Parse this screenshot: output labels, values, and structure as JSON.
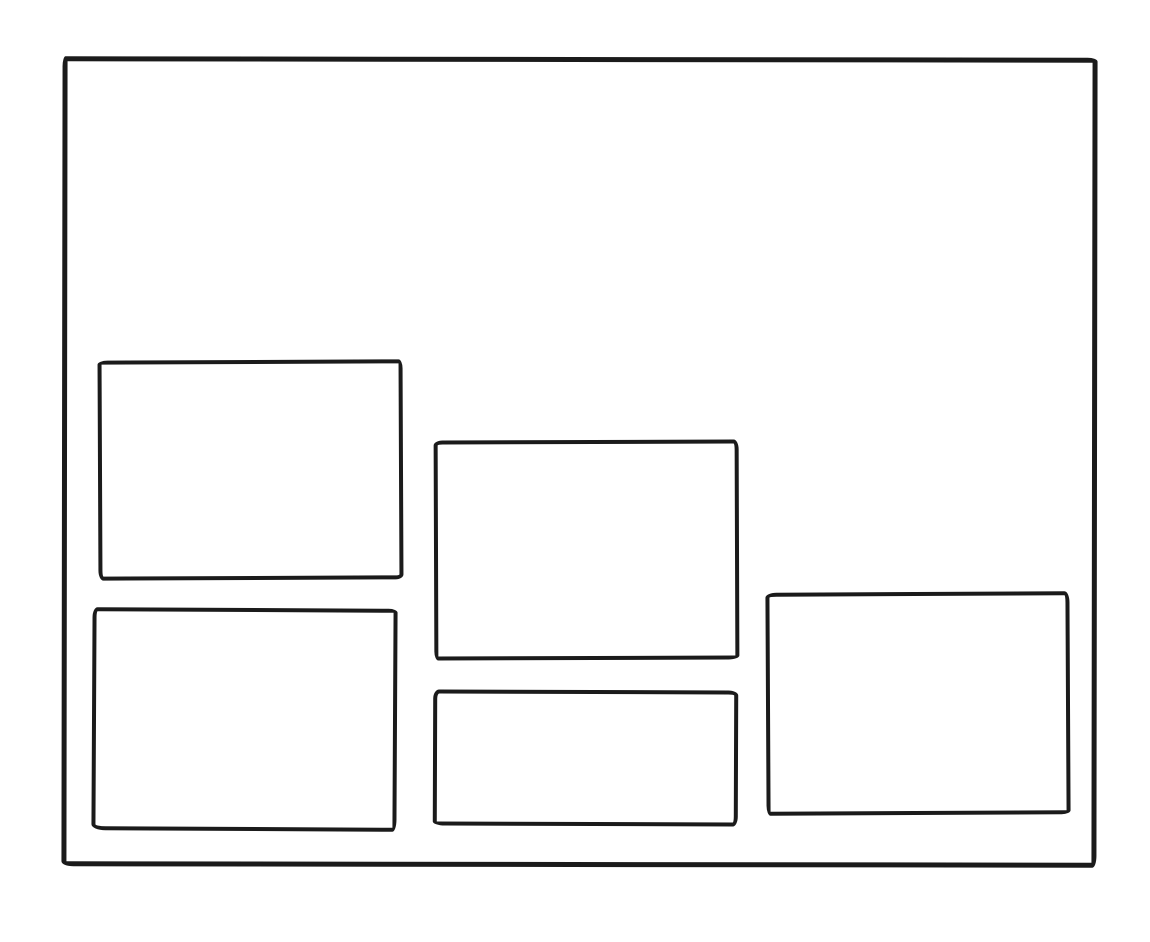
{
  "canvas": {
    "background": "#ffffff",
    "stroke_color": "#1b1b1b",
    "sketch_type": "wireframe",
    "text_content": ""
  },
  "frame": {
    "id": "outer-frame"
  },
  "panels": [
    {
      "id": "panel-top-left"
    },
    {
      "id": "panel-bottom-left"
    },
    {
      "id": "panel-middle-top"
    },
    {
      "id": "panel-middle-bottom"
    },
    {
      "id": "panel-right"
    }
  ]
}
